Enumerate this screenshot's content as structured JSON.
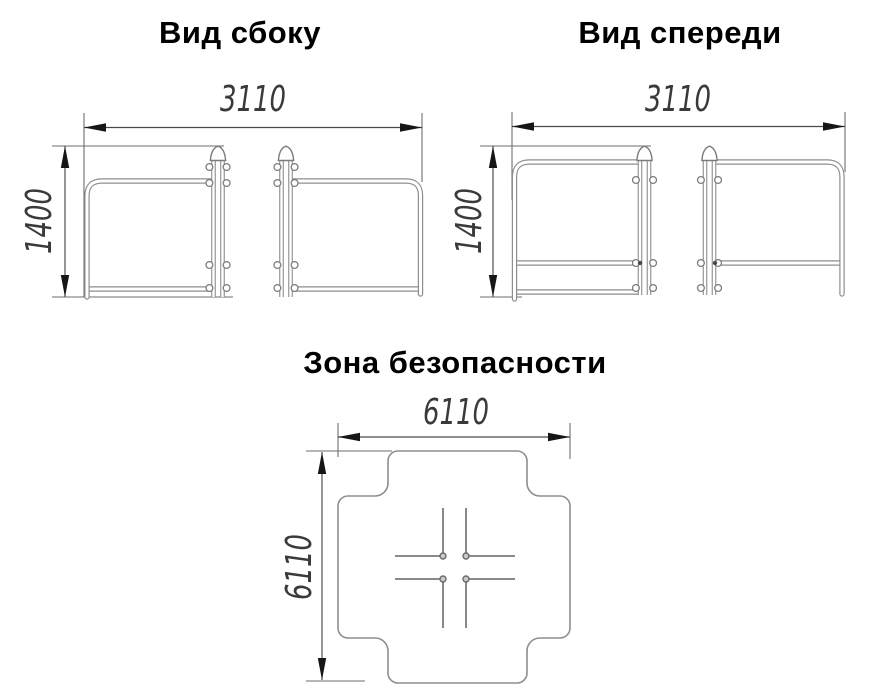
{
  "views": {
    "side": {
      "title": "Вид сбоку",
      "width_label": "3110",
      "height_label": "1400"
    },
    "front": {
      "title": "Вид спереди",
      "width_label": "3110",
      "height_label": "1400"
    },
    "zone": {
      "title": "Зона безопасности",
      "width_label": "6110",
      "height_label": "6110"
    }
  }
}
